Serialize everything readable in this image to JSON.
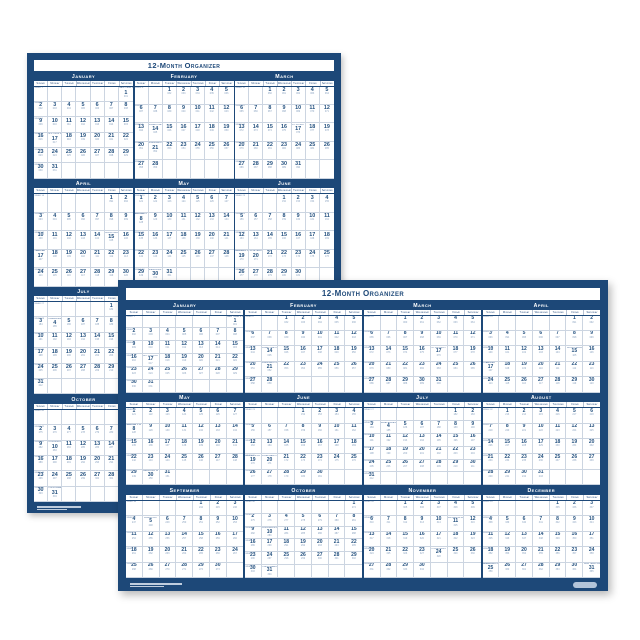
{
  "page": {
    "background_color": "#ffffff"
  },
  "posters": [
    {
      "title": "12-Month Organizer",
      "orientation": "portrait",
      "month_grid": "3 columns x 4 rows"
    },
    {
      "title": "12-Month Organizer",
      "orientation": "landscape",
      "month_grid": "4 columns x 3 rows"
    }
  ],
  "calendar": {
    "year": 2022,
    "week_label": "Week",
    "weekdays": [
      "Sunday",
      "Monday",
      "Tuesday",
      "Wednesday",
      "Thursday",
      "Friday",
      "Saturday"
    ],
    "months": [
      {
        "name": "January",
        "start_dow": 6,
        "days": 31
      },
      {
        "name": "February",
        "start_dow": 2,
        "days": 28
      },
      {
        "name": "March",
        "start_dow": 2,
        "days": 31
      },
      {
        "name": "April",
        "start_dow": 5,
        "days": 30
      },
      {
        "name": "May",
        "start_dow": 0,
        "days": 31
      },
      {
        "name": "June",
        "start_dow": 3,
        "days": 30
      },
      {
        "name": "July",
        "start_dow": 5,
        "days": 31
      },
      {
        "name": "August",
        "start_dow": 1,
        "days": 31
      },
      {
        "name": "September",
        "start_dow": 4,
        "days": 30
      },
      {
        "name": "October",
        "start_dow": 6,
        "days": 31
      },
      {
        "name": "November",
        "start_dow": 2,
        "days": 30
      },
      {
        "name": "December",
        "start_dow": 4,
        "days": 31
      }
    ],
    "holidays": [
      {
        "month": 1,
        "day": 1,
        "label": "New Year's Day"
      },
      {
        "month": 1,
        "day": 17,
        "label": "M.L. King Day"
      },
      {
        "month": 2,
        "day": 14,
        "label": "Valentine's Day"
      },
      {
        "month": 2,
        "day": 21,
        "label": "Presidents' Day"
      },
      {
        "month": 3,
        "day": 17,
        "label": "St. Patrick's Day"
      },
      {
        "month": 4,
        "day": 15,
        "label": "Good Friday"
      },
      {
        "month": 4,
        "day": 17,
        "label": "Easter"
      },
      {
        "month": 5,
        "day": 8,
        "label": "Mother's Day"
      },
      {
        "month": 5,
        "day": 30,
        "label": "Memorial Day"
      },
      {
        "month": 6,
        "day": 19,
        "label": "Father's Day"
      },
      {
        "month": 6,
        "day": 20,
        "label": "Juneteenth Observed"
      },
      {
        "month": 7,
        "day": 4,
        "label": "Independence Day"
      },
      {
        "month": 9,
        "day": 5,
        "label": "Labor Day"
      },
      {
        "month": 10,
        "day": 10,
        "label": "Columbus Day"
      },
      {
        "month": 10,
        "day": 31,
        "label": "Halloween"
      },
      {
        "month": 11,
        "day": 11,
        "label": "Veterans Day"
      },
      {
        "month": 11,
        "day": 24,
        "label": "Thanksgiving"
      },
      {
        "month": 12,
        "day": 25,
        "label": "Christmas Day"
      },
      {
        "month": 12,
        "day": 31,
        "label": "New Year's Eve"
      }
    ]
  },
  "colors": {
    "navy": "#1d4878",
    "paper": "#ffffff",
    "grid_line": "#ccd5e1",
    "date_number": "#24517f",
    "julian_number": "#8ba3c0"
  }
}
